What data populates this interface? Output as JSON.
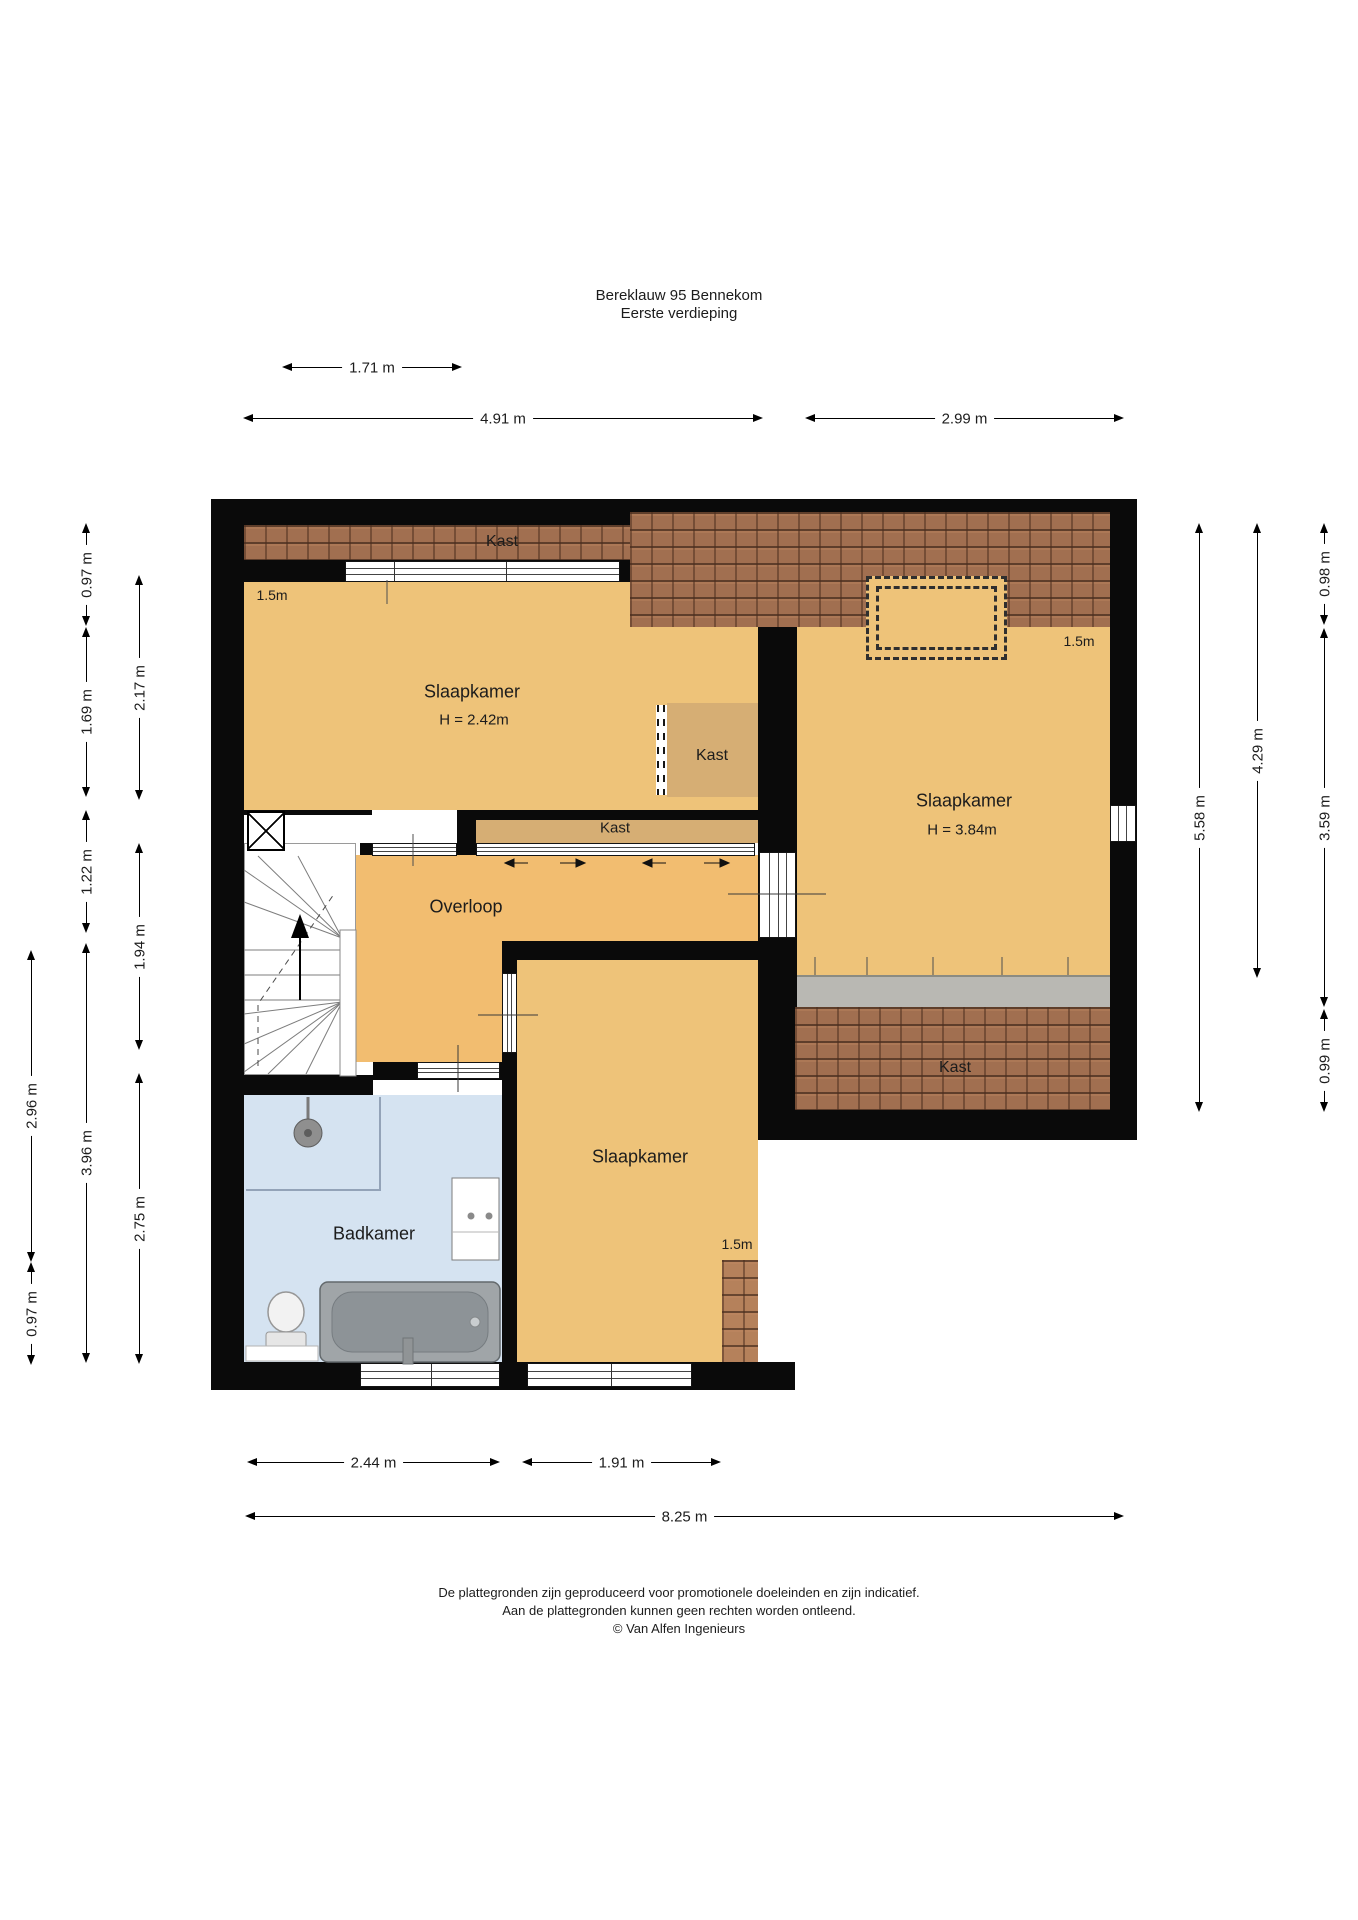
{
  "title": {
    "line1": "Bereklauw 95 Bennekom",
    "line2": "Eerste verdieping"
  },
  "rooms": {
    "bedroom_left": {
      "name": "Slaapkamer",
      "ceiling_height": "H = 2.42m"
    },
    "bedroom_right": {
      "name": "Slaapkamer",
      "ceiling_height": "H = 3.84m"
    },
    "bedroom_bottom": {
      "name": "Slaapkamer"
    },
    "bathroom": {
      "name": "Badkamer"
    },
    "landing": {
      "name": "Overloop"
    },
    "closet_top": {
      "name": "Kast"
    },
    "closet_middle": {
      "name": "Kast"
    },
    "closet_hall": {
      "name": "Kast"
    },
    "closet_bedroom_right": {
      "name": "Kast"
    }
  },
  "roof_height_labels": {
    "bedroom_left": "1.5m",
    "bedroom_right": "1.5m",
    "bedroom_bottom": "1.5m"
  },
  "dimensions": {
    "top": [
      {
        "label": "1.71 m"
      },
      {
        "label": "4.91 m"
      },
      {
        "label": "2.99 m"
      }
    ],
    "bottom": [
      {
        "label": "2.44 m"
      },
      {
        "label": "1.91 m"
      },
      {
        "label": "8.25 m"
      }
    ],
    "left": [
      {
        "label": "0.97 m"
      },
      {
        "label": "1.69 m"
      },
      {
        "label": "1.22 m"
      },
      {
        "label": "3.96 m"
      },
      {
        "label": "2.17 m"
      },
      {
        "label": "1.94 m"
      },
      {
        "label": "2.75 m"
      },
      {
        "label": "2.96 m"
      },
      {
        "label": "0.97 m"
      }
    ],
    "right": [
      {
        "label": "5.58 m"
      },
      {
        "label": "4.29 m"
      },
      {
        "label": "0.98 m"
      },
      {
        "label": "3.59 m"
      },
      {
        "label": "0.99 m"
      }
    ]
  },
  "footer": {
    "line1": "De plattegronden zijn geproduceerd voor promotionele doeleinden en zijn indicatief.",
    "line2": "Aan de plattegronden kunnen geen rechten worden ontleend.",
    "line3": "© Van Alfen Ingenieurs"
  },
  "colors": {
    "wall": "#0a0a0a",
    "room_fill": "#eec379",
    "landing_fill": "#f2bd70",
    "closet_fill": "#d6ae74",
    "bathroom_fill": "#d5e3f1",
    "roof_tiles": "#a16f50",
    "closet_doors_gray": "#b9b8b3"
  }
}
